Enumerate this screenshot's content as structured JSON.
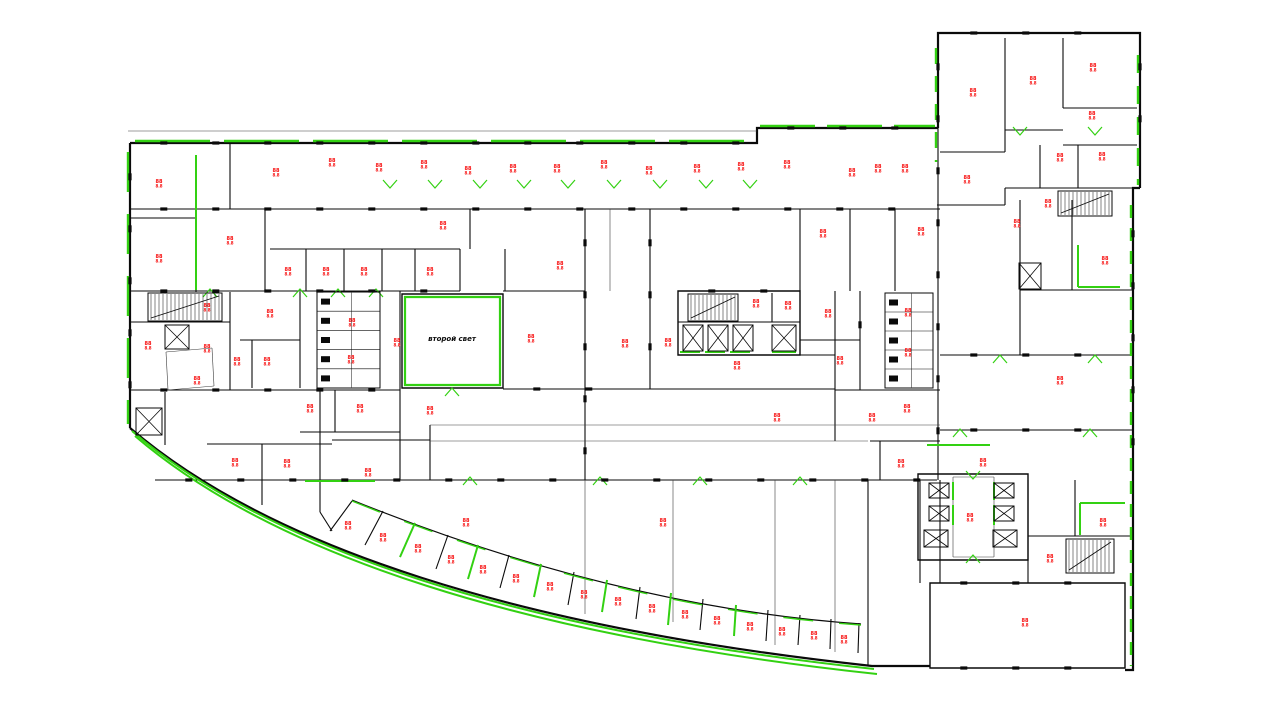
{
  "drawing": {
    "type": "architectural-floor-plan",
    "atrium_label": {
      "text": "второй свет",
      "x": 452,
      "y": 341
    },
    "room_label_glyph": {
      "top": "88",
      "bottom": "8.8"
    },
    "colors": {
      "background": "#ffffff",
      "wall": "#0a0a0a",
      "thin": "#3c3c3c",
      "accent_green": "#33d112",
      "label_red": "#f70808"
    },
    "outline_paths": [
      "M130,143 H757 V128 H938",
      "M130,143 V428",
      "M938,128 V33 H1140 V188",
      "M1140,188 H1133 V480",
      "M1133,480 V670 H1125",
      "M130,428 C270,548 520,628 872,666 L930,666"
    ],
    "inner_arc": "M352,500 C520,568 690,612 861,624",
    "walls": [
      [
        230,
        143,
        230,
        209
      ],
      [
        130,
        218,
        196,
        218
      ],
      [
        196,
        218,
        196,
        292
      ],
      [
        130,
        291,
        460,
        291
      ],
      [
        265,
        209,
        265,
        291
      ],
      [
        270,
        249,
        460,
        249
      ],
      [
        306,
        249,
        306,
        291
      ],
      [
        344,
        249,
        344,
        291
      ],
      [
        382,
        249,
        382,
        291
      ],
      [
        415,
        249,
        415,
        291
      ],
      [
        460,
        249,
        460,
        291
      ],
      [
        130,
        322,
        230,
        322
      ],
      [
        230,
        292,
        230,
        390
      ],
      [
        300,
        292,
        300,
        388
      ],
      [
        240,
        340,
        300,
        340
      ],
      [
        252,
        340,
        252,
        388
      ],
      [
        130,
        390,
        400,
        390
      ],
      [
        320,
        390,
        320,
        512
      ],
      [
        335,
        390,
        335,
        432
      ],
      [
        300,
        432,
        400,
        432
      ],
      [
        207,
        444,
        332,
        444
      ],
      [
        262,
        444,
        262,
        505
      ],
      [
        332,
        440,
        430,
        440
      ],
      [
        430,
        425,
        430,
        480
      ],
      [
        165,
        392,
        165,
        445
      ],
      [
        400,
        291,
        400,
        480
      ],
      [
        470,
        209,
        470,
        249
      ],
      [
        505,
        249,
        505,
        291
      ],
      [
        585,
        209,
        585,
        480
      ],
      [
        503,
        291,
        585,
        291
      ],
      [
        503,
        389,
        835,
        389
      ],
      [
        650,
        209,
        650,
        389
      ],
      [
        678,
        322,
        800,
        322
      ],
      [
        772,
        293,
        772,
        322
      ],
      [
        678,
        355,
        835,
        355
      ],
      [
        835,
        291,
        835,
        441
      ],
      [
        800,
        209,
        800,
        291
      ],
      [
        850,
        209,
        850,
        291
      ],
      [
        895,
        209,
        895,
        291
      ],
      [
        860,
        291,
        860,
        390
      ],
      [
        800,
        340,
        860,
        340
      ],
      [
        835,
        390,
        940,
        390
      ],
      [
        938,
        33,
        938,
        480
      ],
      [
        1020,
        200,
        1020,
        355
      ],
      [
        1072,
        200,
        1072,
        290
      ],
      [
        1020,
        290,
        1133,
        290
      ],
      [
        940,
        355,
        1133,
        355
      ],
      [
        940,
        430,
        1133,
        430
      ],
      [
        1005,
        38,
        1005,
        152
      ],
      [
        1063,
        38,
        1063,
        108
      ],
      [
        1063,
        108,
        1137,
        108
      ],
      [
        1063,
        145,
        1137,
        145
      ],
      [
        1078,
        145,
        1078,
        188
      ],
      [
        1040,
        145,
        1040,
        188
      ],
      [
        1005,
        130,
        1063,
        130
      ],
      [
        940,
        152,
        1005,
        152
      ],
      [
        937,
        205,
        1005,
        205
      ],
      [
        1005,
        188,
        1140,
        188
      ],
      [
        1005,
        188,
        1005,
        205
      ],
      [
        870,
        441,
        940,
        441
      ],
      [
        880,
        441,
        880,
        480
      ],
      [
        920,
        480,
        920,
        583
      ],
      [
        940,
        480,
        940,
        583
      ],
      [
        1028,
        480,
        1028,
        583
      ],
      [
        1028,
        536,
        1133,
        536
      ],
      [
        1075,
        480,
        1075,
        536
      ],
      [
        868,
        480,
        868,
        666
      ],
      [
        868,
        666,
        930,
        666
      ],
      [
        155,
        480,
        937,
        480
      ],
      [
        130,
        209,
        940,
        209
      ],
      [
        330,
        531,
        352,
        501
      ],
      [
        365,
        545,
        383,
        511
      ],
      [
        400,
        557,
        415,
        523
      ],
      [
        436,
        569,
        448,
        535
      ],
      [
        468,
        579,
        478,
        545
      ],
      [
        500,
        588,
        509,
        555
      ],
      [
        534,
        597,
        541,
        564
      ],
      [
        568,
        605,
        574,
        572
      ],
      [
        602,
        612,
        607,
        580
      ],
      [
        636,
        619,
        640,
        587
      ],
      [
        668,
        625,
        671,
        593
      ],
      [
        700,
        630,
        703,
        599
      ],
      [
        734,
        636,
        736,
        605
      ],
      [
        766,
        641,
        768,
        610
      ],
      [
        798,
        645,
        800,
        615
      ],
      [
        830,
        649,
        831,
        619
      ],
      [
        858,
        653,
        859,
        623
      ],
      [
        320,
        512,
        332,
        531
      ]
    ],
    "wall_paths": [
      "M678,291 H800 V355 H678 Z",
      "M402,294 H503 V388 H402 Z",
      "M918,474 H1028 V560 H918 Z",
      "M930,583 H1125 V668 H930 Z"
    ],
    "thin_walls": [
      [
        128,
        131,
        757,
        131
      ],
      [
        430,
        425,
        940,
        425
      ],
      [
        430,
        441,
        868,
        441
      ],
      [
        610,
        209,
        610,
        291
      ],
      [
        585,
        480,
        585,
        614
      ],
      [
        673,
        480,
        673,
        622
      ],
      [
        775,
        480,
        775,
        645
      ],
      [
        835,
        480,
        835,
        652
      ],
      [
        953,
        477,
        994,
        477
      ],
      [
        953,
        477,
        953,
        557
      ],
      [
        994,
        477,
        994,
        557
      ],
      [
        953,
        557,
        994,
        557
      ],
      [
        166,
        352,
        212,
        348
      ],
      [
        212,
        348,
        214,
        386
      ],
      [
        214,
        386,
        168,
        390
      ],
      [
        168,
        390,
        166,
        352
      ]
    ],
    "green_paths": [
      {
        "d": "M405,297 H500 V385 H405 Z",
        "w": 2.2,
        "dash": ""
      },
      {
        "d": "M132,431 C272,551 522,631 874,669",
        "w": 2,
        "dash": ""
      },
      {
        "d": "M135,436 C275,556 525,636 877,674",
        "w": 2,
        "dash": ""
      },
      {
        "d": "M352,501 C520,569 690,613 861,625",
        "w": 1.4,
        "dash": "30,26"
      }
    ],
    "green_lines": [
      [
        196,
        155,
        196,
        290
      ],
      [
        680,
        352,
        700,
        352
      ],
      [
        705,
        352,
        725,
        352
      ],
      [
        730,
        352,
        750,
        352
      ],
      [
        772,
        352,
        796,
        352
      ],
      [
        1078,
        245,
        1078,
        287
      ],
      [
        1078,
        287,
        1120,
        287
      ],
      [
        1080,
        503,
        1125,
        503
      ],
      [
        1080,
        503,
        1080,
        535
      ],
      [
        953,
        482,
        953,
        500
      ],
      [
        953,
        505,
        953,
        525
      ],
      [
        994,
        482,
        994,
        500
      ],
      [
        994,
        505,
        994,
        525
      ],
      [
        927,
        445,
        990,
        445
      ],
      [
        305,
        481,
        375,
        481
      ],
      [
        400,
        557,
        415,
        523
      ],
      [
        468,
        579,
        478,
        545
      ],
      [
        534,
        597,
        541,
        564
      ],
      [
        602,
        612,
        607,
        580
      ],
      [
        668,
        625,
        671,
        593
      ],
      [
        734,
        636,
        736,
        605
      ]
    ],
    "green_dashed": [
      [
        135,
        141,
        752,
        141,
        75,
        14
      ],
      [
        760,
        126,
        935,
        126,
        55,
        12
      ],
      [
        128,
        152,
        128,
        424,
        40,
        22
      ],
      [
        1131,
        205,
        1131,
        666,
        13,
        10
      ],
      [
        936,
        48,
        936,
        162,
        16,
        12
      ],
      [
        1138,
        55,
        1138,
        185,
        18,
        13
      ]
    ],
    "chevrons": [
      [
        390,
        186,
        "d"
      ],
      [
        435,
        186,
        "d"
      ],
      [
        480,
        186,
        "d"
      ],
      [
        524,
        186,
        "d"
      ],
      [
        568,
        186,
        "d"
      ],
      [
        614,
        186,
        "d"
      ],
      [
        660,
        186,
        "d"
      ],
      [
        706,
        186,
        "d"
      ],
      [
        750,
        186,
        "d"
      ],
      [
        300,
        291,
        "u"
      ],
      [
        338,
        291,
        "u"
      ],
      [
        376,
        291,
        "u"
      ],
      [
        210,
        291,
        "u"
      ],
      [
        452,
        390,
        "u"
      ],
      [
        470,
        479,
        "u"
      ],
      [
        600,
        479,
        "u"
      ],
      [
        700,
        479,
        "u"
      ],
      [
        800,
        479,
        "u"
      ],
      [
        1000,
        357,
        "u"
      ],
      [
        1095,
        357,
        "u"
      ],
      [
        960,
        431,
        "u"
      ],
      [
        1090,
        431,
        "u"
      ],
      [
        973,
        477,
        "d"
      ],
      [
        973,
        557,
        "u"
      ],
      [
        1020,
        133,
        "d"
      ],
      [
        1095,
        133,
        "d"
      ]
    ],
    "elevators": [
      [
        165,
        325,
        24,
        24
      ],
      [
        136,
        408,
        26,
        27
      ],
      [
        683,
        325,
        20,
        26
      ],
      [
        708,
        325,
        20,
        26
      ],
      [
        733,
        325,
        20,
        26
      ],
      [
        772,
        325,
        24,
        26
      ],
      [
        1019,
        263,
        22,
        26
      ],
      [
        929,
        483,
        20,
        15
      ],
      [
        929,
        506,
        20,
        15
      ],
      [
        924,
        530,
        24,
        17
      ],
      [
        994,
        483,
        20,
        15
      ],
      [
        994,
        506,
        20,
        15
      ],
      [
        993,
        530,
        24,
        17
      ]
    ],
    "stairs": [
      [
        148,
        293,
        74,
        28
      ],
      [
        688,
        294,
        50,
        27
      ],
      [
        1058,
        191,
        54,
        25
      ],
      [
        1066,
        539,
        48,
        34
      ]
    ],
    "stalls": [
      [
        317,
        292,
        63,
        96,
        5
      ],
      [
        885,
        293,
        48,
        95,
        5
      ]
    ],
    "tick_walls": [
      [
        130,
        143,
        757,
        143
      ],
      [
        757,
        128,
        937,
        128
      ],
      [
        130,
        143,
        130,
        428
      ],
      [
        130,
        209,
        940,
        209
      ],
      [
        130,
        291,
        460,
        291
      ],
      [
        130,
        390,
        400,
        390
      ],
      [
        155,
        480,
        937,
        480
      ],
      [
        938,
        33,
        938,
        480
      ],
      [
        1133,
        200,
        1133,
        480
      ],
      [
        940,
        33,
        1140,
        33
      ],
      [
        1140,
        33,
        1140,
        188
      ],
      [
        930,
        583,
        1125,
        583
      ],
      [
        930,
        668,
        1125,
        668
      ],
      [
        940,
        355,
        1133,
        355
      ],
      [
        940,
        430,
        1133,
        430
      ],
      [
        503,
        389,
        655,
        389
      ],
      [
        678,
        291,
        800,
        291
      ],
      [
        585,
        209,
        585,
        480
      ],
      [
        650,
        209,
        650,
        389
      ],
      [
        860,
        291,
        860,
        390
      ]
    ],
    "tick_interval": 52,
    "room_labels": [
      [
        159,
        183
      ],
      [
        276,
        172
      ],
      [
        332,
        162
      ],
      [
        379,
        167
      ],
      [
        424,
        164
      ],
      [
        468,
        170
      ],
      [
        513,
        168
      ],
      [
        557,
        168
      ],
      [
        604,
        164
      ],
      [
        649,
        170
      ],
      [
        697,
        168
      ],
      [
        741,
        166
      ],
      [
        787,
        164
      ],
      [
        852,
        172
      ],
      [
        878,
        168
      ],
      [
        905,
        168
      ],
      [
        967,
        179
      ],
      [
        973,
        92
      ],
      [
        1033,
        80
      ],
      [
        1093,
        67
      ],
      [
        1092,
        115
      ],
      [
        1060,
        157
      ],
      [
        1102,
        156
      ],
      [
        1048,
        203
      ],
      [
        1017,
        223
      ],
      [
        1105,
        260
      ],
      [
        1060,
        380
      ],
      [
        230,
        240
      ],
      [
        443,
        225
      ],
      [
        823,
        233
      ],
      [
        921,
        231
      ],
      [
        159,
        258
      ],
      [
        288,
        271
      ],
      [
        326,
        271
      ],
      [
        364,
        271
      ],
      [
        430,
        271
      ],
      [
        560,
        265
      ],
      [
        207,
        307
      ],
      [
        270,
        313
      ],
      [
        148,
        345
      ],
      [
        207,
        348
      ],
      [
        237,
        361
      ],
      [
        267,
        361
      ],
      [
        352,
        322
      ],
      [
        351,
        359
      ],
      [
        397,
        342
      ],
      [
        197,
        380
      ],
      [
        310,
        408
      ],
      [
        360,
        408
      ],
      [
        430,
        410
      ],
      [
        531,
        338
      ],
      [
        625,
        343
      ],
      [
        668,
        342
      ],
      [
        737,
        365
      ],
      [
        756,
        303
      ],
      [
        788,
        305
      ],
      [
        828,
        313
      ],
      [
        840,
        360
      ],
      [
        908,
        312
      ],
      [
        908,
        352
      ],
      [
        777,
        417
      ],
      [
        872,
        417
      ],
      [
        907,
        408
      ],
      [
        235,
        462
      ],
      [
        287,
        463
      ],
      [
        368,
        472
      ],
      [
        466,
        522
      ],
      [
        663,
        522
      ],
      [
        348,
        525
      ],
      [
        383,
        537
      ],
      [
        418,
        548
      ],
      [
        451,
        559
      ],
      [
        483,
        569
      ],
      [
        516,
        578
      ],
      [
        550,
        586
      ],
      [
        584,
        594
      ],
      [
        618,
        601
      ],
      [
        652,
        608
      ],
      [
        685,
        614
      ],
      [
        717,
        620
      ],
      [
        750,
        626
      ],
      [
        782,
        631
      ],
      [
        814,
        635
      ],
      [
        844,
        639
      ],
      [
        901,
        463
      ],
      [
        983,
        462
      ],
      [
        970,
        517
      ],
      [
        1103,
        522
      ],
      [
        1050,
        558
      ],
      [
        1025,
        622
      ]
    ]
  }
}
